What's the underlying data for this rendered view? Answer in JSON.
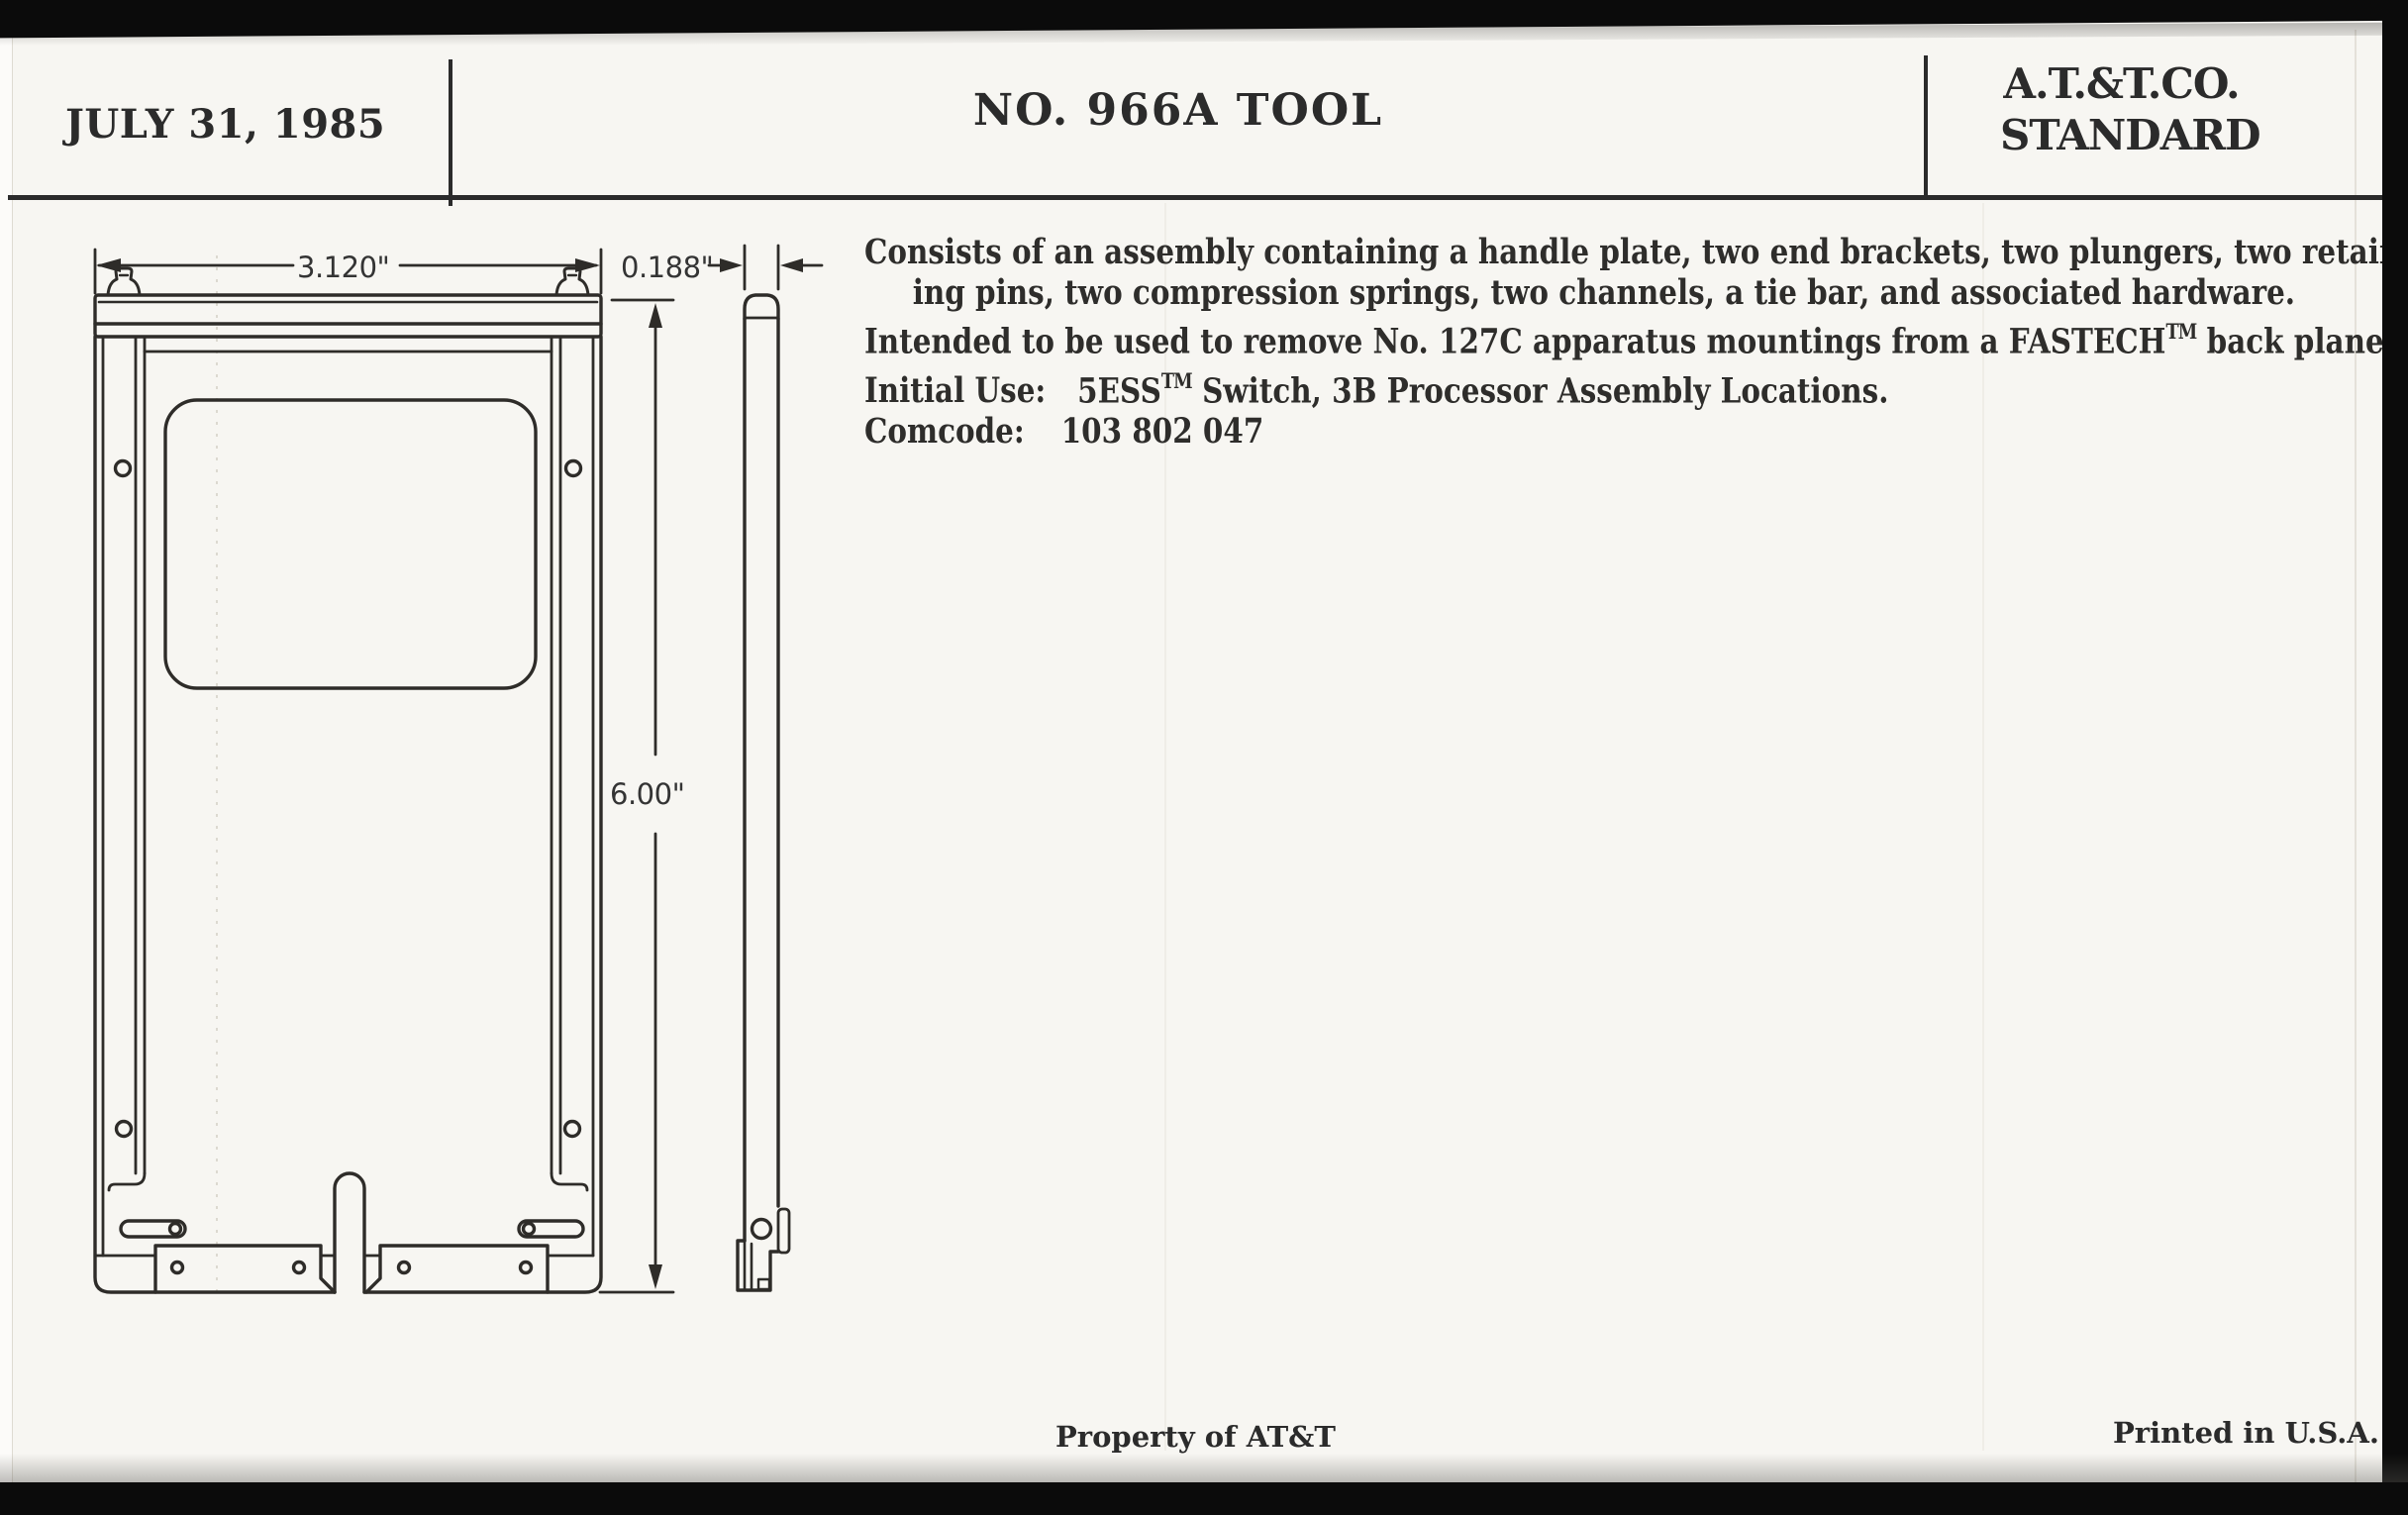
{
  "header": {
    "date": "JULY 31, 1985",
    "title": "NO. 966A TOOL",
    "org": {
      "line1": "A.T.&T.CO.",
      "line2": "STANDARD"
    }
  },
  "description": {
    "line1": "Consists of an assembly containing a handle plate, two end brackets, two plungers, two retain-",
    "line2": "ing pins, two compression springs, two channels, a tie bar, and associated hardware.",
    "line3": {
      "pre": "Intended to be used to remove No. 127C apparatus mountings from a FASTECH",
      "tm": "TM",
      "post": " back plane."
    },
    "line4": {
      "label": "Initial Use:",
      "value_pre": "5ESS",
      "tm": "TM",
      "value_post": " Switch, 3B Processor Assembly Locations."
    },
    "line5": {
      "label": "Comcode:",
      "value": "103 802 047"
    }
  },
  "drawing": {
    "views": [
      "front-view",
      "side-view"
    ],
    "dimensions": {
      "width": "3.120\"",
      "thickness": "0.188\"",
      "height": "6.00\""
    }
  },
  "footer": {
    "left_note": "Property of AT&T",
    "right_note": "Printed in U.S.A."
  },
  "colors": {
    "paper": "#f7f6f2",
    "ink": "#2b2b2b",
    "scan_edge": "#0b0b0b"
  }
}
